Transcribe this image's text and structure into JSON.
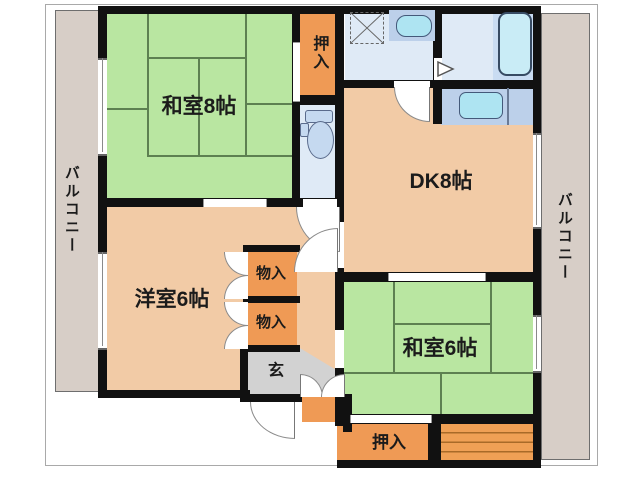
{
  "diagram_type": "japanese-apartment-floor-plan",
  "rooms": {
    "washitsu8": {
      "label": "和室8帖",
      "type": "japanese-tatami-room",
      "size_jo": 8
    },
    "dk": {
      "label": "DK8帖",
      "type": "dining-kitchen",
      "size_jo": 8
    },
    "yoshitsu6": {
      "label": "洋室6帖",
      "type": "western-room",
      "size_jo": 6
    },
    "washitsu6": {
      "label": "和室6帖",
      "type": "japanese-tatami-room",
      "size_jo": 6
    },
    "oshiire_top": {
      "label": "押入",
      "type": "closet"
    },
    "oshiire_bottom": {
      "label": "押入",
      "type": "closet"
    },
    "monoire_upper": {
      "label": "物入",
      "type": "storage"
    },
    "monoire_lower": {
      "label": "物入",
      "type": "storage"
    },
    "genkan": {
      "label": "玄",
      "type": "entrance"
    },
    "balcony_left": {
      "label": "バルコニー",
      "type": "balcony"
    },
    "balcony_right": {
      "label": "バルコニー",
      "type": "balcony"
    }
  },
  "fixtures": [
    "bathtub",
    "washbasin",
    "washing-machine-pan",
    "toilet",
    "kitchen-sink",
    "shelf-stripes"
  ],
  "palette": {
    "tatami_green": "#b9e6a1",
    "floor_tan": "#f2cba6",
    "closet_orange": "#ef9a55",
    "wet_room_blue": "#dfeaf6",
    "fixture_cyan": "#aee4f2",
    "counter_blue": "#bcd0ea",
    "genkan_gray": "#d2d2d2",
    "balcony_beige": "#d7cec7",
    "wall_black": "#111111"
  }
}
